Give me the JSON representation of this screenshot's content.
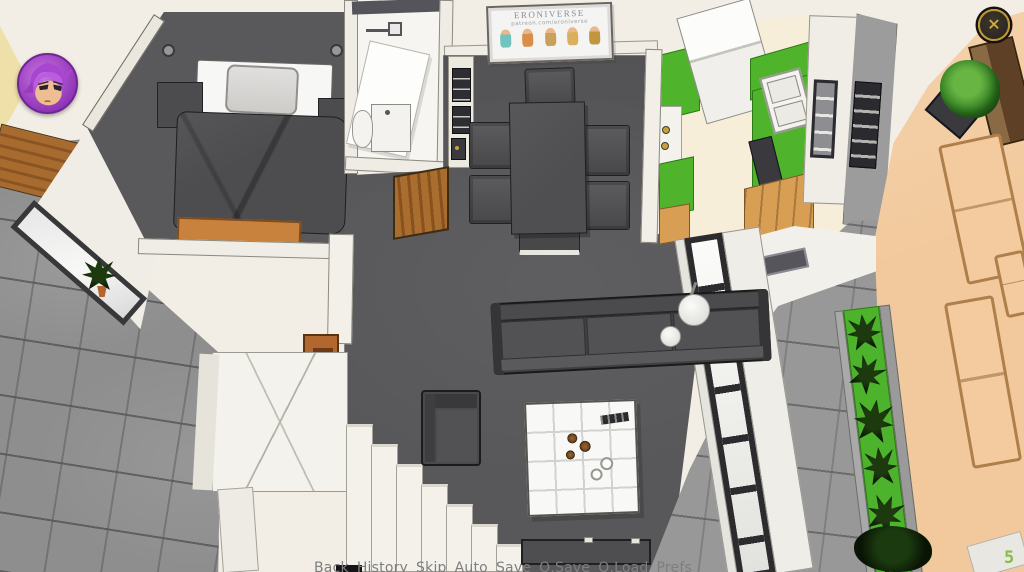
{
  "hud": {
    "close_glyph": "✕",
    "fps_counter": "5",
    "colors": {
      "counter_green": "#86bb4a",
      "close_gold": "#bd9733",
      "avatar_purple": "#a846cf"
    }
  },
  "poster": {
    "title": "ERONIVERSE",
    "subtitle": "patreon.com/eroniverse"
  },
  "quick_menu": {
    "items": [
      {
        "label": "Back"
      },
      {
        "label": "History"
      },
      {
        "label": "Skip"
      },
      {
        "label": "Auto"
      },
      {
        "label": "Save"
      },
      {
        "label": "Q.Save"
      },
      {
        "label": "Q.Load"
      },
      {
        "label": "Prefs"
      }
    ]
  },
  "scene": {
    "colors": {
      "floor_dark": "#58585a",
      "kitchen_counter_green": "#4fb42c",
      "planter_green": "#4db22c",
      "terrace_tan": "#f2c99c",
      "balcony_tile_gray": "#8e8e8e",
      "wood_brown": "#a96d30"
    }
  }
}
